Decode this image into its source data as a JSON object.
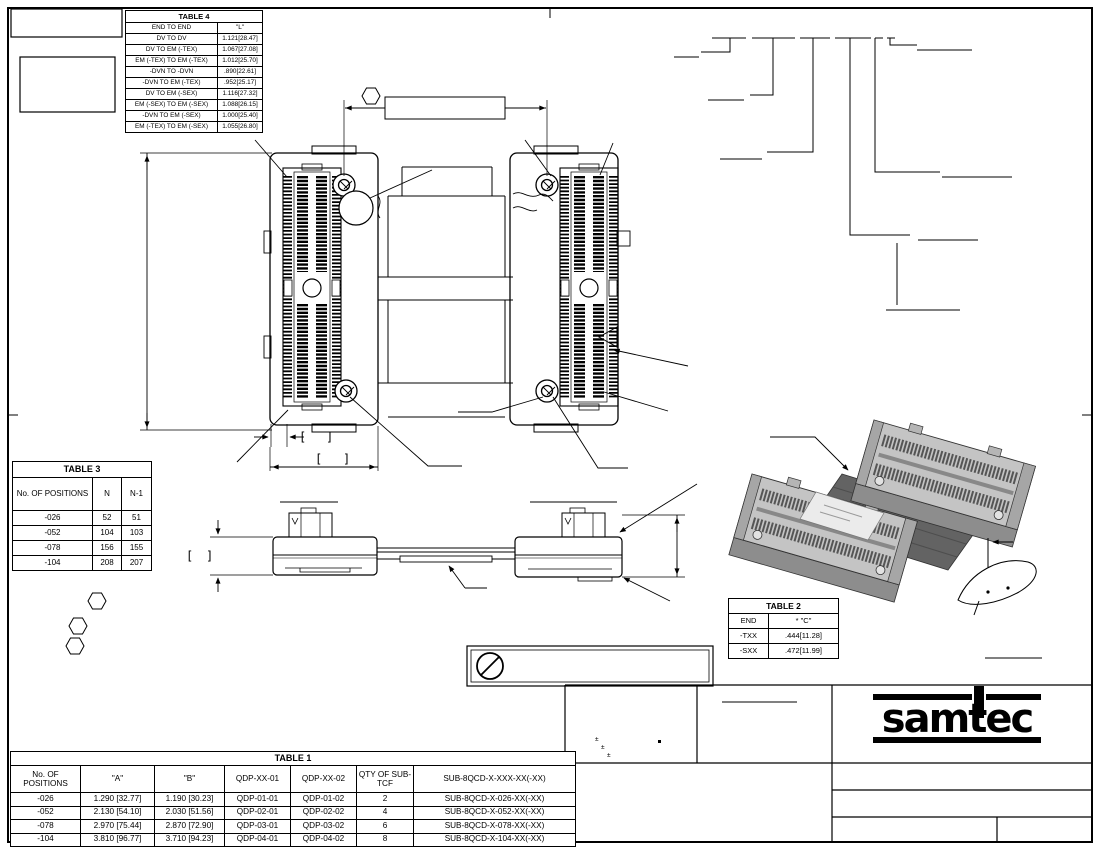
{
  "sheet": {
    "brackets": {
      "open": "[",
      "close": "]"
    },
    "tolerance_mark": "±"
  },
  "tables": {
    "table4": {
      "title": "TABLE 4",
      "headers": [
        "END TO END",
        "\"L\""
      ],
      "rows": [
        [
          "DV TO DV",
          "1.121[28.47]"
        ],
        [
          "DV TO EM (-TEX)",
          "1.067[27.08]"
        ],
        [
          "EM (-TEX) TO EM (-TEX)",
          "1.012[25.70]"
        ],
        [
          "-DVN TO -DVN",
          ".890[22.61]"
        ],
        [
          "-DVN TO EM (-TEX)",
          ".952[25.17]"
        ],
        [
          "DV TO EM (-SEX)",
          "1.116[27.32]"
        ],
        [
          "EM (-SEX) TO EM (-SEX)",
          "1.088[26.15]"
        ],
        [
          "-DVN TO EM (-SEX)",
          "1.000[25.40]"
        ],
        [
          "EM (-TEX) TO EM (-SEX)",
          "1.055[26.80]"
        ]
      ]
    },
    "table3": {
      "title": "TABLE 3",
      "headers": [
        "No. OF POSITIONS",
        "N",
        "N-1"
      ],
      "rows": [
        [
          "-026",
          "52",
          "51"
        ],
        [
          "-052",
          "104",
          "103"
        ],
        [
          "-078",
          "156",
          "155"
        ],
        [
          "-104",
          "208",
          "207"
        ]
      ]
    },
    "table2": {
      "title": "TABLE 2",
      "headers": [
        "END",
        "* \"C\""
      ],
      "rows": [
        [
          "-TXX",
          ".444[11.28]"
        ],
        [
          "-SXX",
          ".472[11.99]"
        ]
      ]
    },
    "table1": {
      "title": "TABLE 1",
      "headers": [
        "No. OF POSITIONS",
        "\"A\"",
        "\"B\"",
        "QDP-XX-01",
        "QDP-XX-02",
        "QTY OF SUB-TCF",
        "SUB-8QCD-X-XXX-XX(-XX)"
      ],
      "rows": [
        [
          "-026",
          "1.290 [32.77]",
          "1.190 [30.23]",
          "QDP-01-01",
          "QDP-01-02",
          "2",
          "SUB-8QCD-X-026-XX(-XX)"
        ],
        [
          "-052",
          "2.130 [54.10]",
          "2.030 [51.56]",
          "QDP-02-01",
          "QDP-02-02",
          "4",
          "SUB-8QCD-X-052-XX(-XX)"
        ],
        [
          "-078",
          "2.970 [75.44]",
          "2.870 [72.90]",
          "QDP-03-01",
          "QDP-03-02",
          "6",
          "SUB-8QCD-X-078-XX(-XX)"
        ],
        [
          "-104",
          "3.810 [96.77]",
          "3.710 [94.23]",
          "QDP-04-01",
          "QDP-04-02",
          "8",
          "SUB-8QCD-X-104-XX(-XX)"
        ]
      ]
    }
  },
  "title_block": {
    "brand": "samtec"
  },
  "colors": {
    "line": "#000000",
    "iso_light": "#c4c4c4",
    "iso_mid": "#a6a6a6",
    "iso_dark": "#8d8d8d",
    "cable": "#636363",
    "label": "#ebebeb"
  }
}
